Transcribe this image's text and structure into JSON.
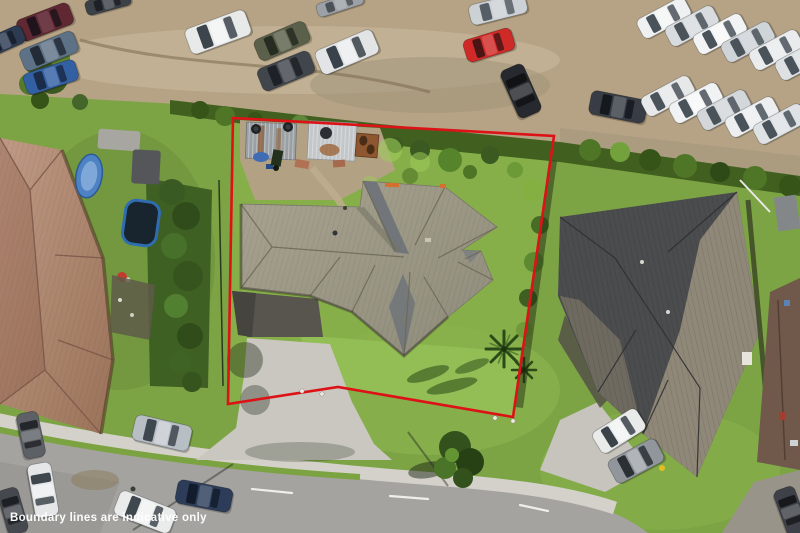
{
  "image": {
    "kind": "aerial-drone-photograph",
    "subject": "residential property with red boundary overlay, neighbouring houses, car yards and cul-de-sac street"
  },
  "overlay": {
    "disclaimer_text": "Boundary lines are indicative only",
    "disclaimer_color": "#ffffff",
    "boundary_color": "#dd1217",
    "boundary_width": 2.6,
    "boundary_points": "233,118 554,136 513,417 338,387 228,404",
    "peg_markers": [
      [
        302,
        391
      ],
      [
        322,
        394
      ],
      [
        495,
        418
      ],
      [
        513,
        421
      ]
    ]
  },
  "palette": {
    "boundary_red": "#dd1217",
    "watermark_white": "#ffffff",
    "grass_base": "#7ca344",
    "grass_light": "#96bf57",
    "grass_dark": "#4e7426",
    "hedge_dark": "#3a5a22",
    "gravel": "#b6a385",
    "dirt": "#ab9c80",
    "road_asphalt": "#a4a3a0",
    "footpath_concrete": "#d3d1c9",
    "driveway_concrete": "#c9c7bf",
    "subject_roof": "#a29d8b",
    "subject_roof_shadow": "#6a7078",
    "left_roof_brown": "#b08a74",
    "right_roof_dark": "#4b4c4e",
    "right_roof_light": "#8f8878"
  },
  "scene": {
    "cars": [
      {
        "name": "car-maroon-gravel",
        "x": 45,
        "y": 22,
        "l": 56,
        "w": 23,
        "r": -21,
        "body": "#5f2833",
        "glass": "#20141c",
        "roof": "rgba(255,255,255,0.10)"
      },
      {
        "name": "car-navy-edge",
        "x": 4,
        "y": 41,
        "l": 42,
        "w": 19,
        "r": -24,
        "body": "#2c3a52",
        "glass": "#161c28"
      },
      {
        "name": "car-steelblue-gravel",
        "x": 49,
        "y": 51,
        "l": 58,
        "w": 23,
        "r": -22,
        "body": "#5e7287",
        "glass": "#232c36"
      },
      {
        "name": "car-blue-gravel",
        "x": 51,
        "y": 77,
        "l": 54,
        "w": 22,
        "r": -18,
        "body": "#335fa3",
        "glass": "#1a2c48"
      },
      {
        "name": "car-dark-top-edge",
        "x": 108,
        "y": 3,
        "l": 46,
        "w": 15,
        "r": -15,
        "body": "#3c4148",
        "glass": "#1d2126"
      },
      {
        "name": "suv-white-gravel",
        "x": 218,
        "y": 32,
        "l": 64,
        "w": 27,
        "r": -20,
        "body": "#e8eaea",
        "glass": "#3c444c",
        "roof": "rgba(255,255,255,0.5)"
      },
      {
        "name": "car-olive-gravel",
        "x": 282,
        "y": 41,
        "l": 55,
        "w": 23,
        "r": -23,
        "body": "#5b604a",
        "glass": "#272c22"
      },
      {
        "name": "car-charcoal-gravel",
        "x": 286,
        "y": 71,
        "l": 56,
        "w": 24,
        "r": -22,
        "body": "#41454c",
        "glass": "#1e2126"
      },
      {
        "name": "ute-white-gravel",
        "x": 347,
        "y": 52,
        "l": 62,
        "w": 26,
        "r": -23,
        "body": "#e2e4e5",
        "glass": "#39414a",
        "roof": "rgba(255,255,255,0.45)"
      },
      {
        "name": "car-gray-top-edge",
        "x": 340,
        "y": 4,
        "l": 48,
        "w": 14,
        "r": -18,
        "body": "#9ba1a6",
        "glass": "#4a5258"
      },
      {
        "name": "car-silver-top",
        "x": 498,
        "y": 9,
        "l": 58,
        "w": 21,
        "r": -14,
        "body": "#ccd1d5",
        "glass": "#555e66"
      },
      {
        "name": "car-red-gravel",
        "x": 489,
        "y": 45,
        "l": 50,
        "w": 23,
        "r": -17,
        "body": "#d02a28",
        "glass": "#4a1514"
      },
      {
        "name": "car-black-gravel",
        "x": 521,
        "y": 91,
        "l": 52,
        "w": 25,
        "r": 66,
        "body": "#26292e",
        "glass": "#101214"
      },
      {
        "name": "suv-dark-gravel",
        "x": 618,
        "y": 107,
        "l": 57,
        "w": 24,
        "r": 11,
        "body": "#383d45",
        "glass": "#15181d"
      },
      {
        "name": "fleet-van-1",
        "x": 664,
        "y": 18,
        "l": 54,
        "w": 22,
        "r": -28,
        "body": "#eef0f1",
        "glass": "#4a525a",
        "roof": "rgba(255,255,255,0.45)"
      },
      {
        "name": "fleet-van-2",
        "x": 692,
        "y": 26,
        "l": 54,
        "w": 22,
        "r": -28,
        "body": "#d8dcdf",
        "glass": "#4a525a"
      },
      {
        "name": "fleet-van-3",
        "x": 720,
        "y": 34,
        "l": 54,
        "w": 22,
        "r": -28,
        "body": "#f2f3f4",
        "glass": "#4a525a",
        "roof": "rgba(255,255,255,0.5)"
      },
      {
        "name": "fleet-van-4",
        "x": 748,
        "y": 42,
        "l": 54,
        "w": 22,
        "r": -28,
        "body": "#cfd4d8",
        "glass": "#4a525a"
      },
      {
        "name": "fleet-van-5",
        "x": 776,
        "y": 50,
        "l": 54,
        "w": 22,
        "r": -28,
        "body": "#e9ebec",
        "glass": "#4a525a"
      },
      {
        "name": "fleet-van-6",
        "x": 802,
        "y": 60,
        "l": 54,
        "w": 22,
        "r": -28,
        "body": "#dde1e4",
        "glass": "#4a525a"
      },
      {
        "name": "fleet-van-7",
        "x": 668,
        "y": 96,
        "l": 54,
        "w": 22,
        "r": -28,
        "body": "#e6e8ea",
        "glass": "#4a525a"
      },
      {
        "name": "fleet-van-8",
        "x": 696,
        "y": 103,
        "l": 54,
        "w": 22,
        "r": -28,
        "body": "#f1f2f3",
        "glass": "#4a525a",
        "roof": "rgba(255,255,255,0.5)"
      },
      {
        "name": "fleet-van-9",
        "x": 724,
        "y": 110,
        "l": 54,
        "w": 22,
        "r": -28,
        "body": "#d3d7da",
        "glass": "#4a525a"
      },
      {
        "name": "fleet-van-10",
        "x": 752,
        "y": 117,
        "l": 54,
        "w": 22,
        "r": -28,
        "body": "#eceeef",
        "glass": "#4a525a"
      },
      {
        "name": "fleet-van-11",
        "x": 780,
        "y": 124,
        "l": 54,
        "w": 22,
        "r": -28,
        "body": "#dfe2e4",
        "glass": "#4a525a"
      },
      {
        "name": "car-gray-road-left",
        "x": 31,
        "y": 435,
        "l": 46,
        "w": 22,
        "r": 78,
        "body": "#5d6166",
        "glass": "#23262a"
      },
      {
        "name": "car-white-road-left",
        "x": 43,
        "y": 490,
        "l": 54,
        "w": 24,
        "r": 80,
        "body": "#e4e6e7",
        "glass": "#3e464e",
        "roof": "rgba(255,255,255,0.45)"
      },
      {
        "name": "car-dark-corner-left",
        "x": 13,
        "y": 511,
        "l": 46,
        "w": 21,
        "r": 74,
        "body": "#45494f",
        "glass": "#1d2025"
      },
      {
        "name": "suv-silver-road",
        "x": 162,
        "y": 433,
        "l": 58,
        "w": 26,
        "r": 13,
        "body": "#b7bec4",
        "glass": "#3f474e",
        "roof": "rgba(255,255,255,0.35)"
      },
      {
        "name": "sedan-navy-road",
        "x": 204,
        "y": 496,
        "l": 56,
        "w": 24,
        "r": 11,
        "body": "#2d3d59",
        "glass": "#131c2b"
      },
      {
        "name": "sedan-white-road",
        "x": 145,
        "y": 512,
        "l": 60,
        "w": 26,
        "r": 21,
        "body": "#eaecec",
        "glass": "#40484f",
        "roof": "rgba(255,255,255,0.45)"
      },
      {
        "name": "van-white-driveway",
        "x": 619,
        "y": 431,
        "l": 52,
        "w": 25,
        "r": -32,
        "body": "#e9ebeb",
        "glass": "#3a424a",
        "roof": "rgba(255,255,255,0.5)"
      },
      {
        "name": "truck-gray-driveway",
        "x": 636,
        "y": 461,
        "l": 54,
        "w": 26,
        "r": -28,
        "body": "#90969b",
        "glass": "#2b3035",
        "roof": "rgba(255,255,255,0.3)"
      },
      {
        "name": "car-dark-br-corner",
        "x": 791,
        "y": 511,
        "l": 48,
        "w": 22,
        "r": 70,
        "body": "#3e4248",
        "glass": "#17191d"
      }
    ]
  }
}
